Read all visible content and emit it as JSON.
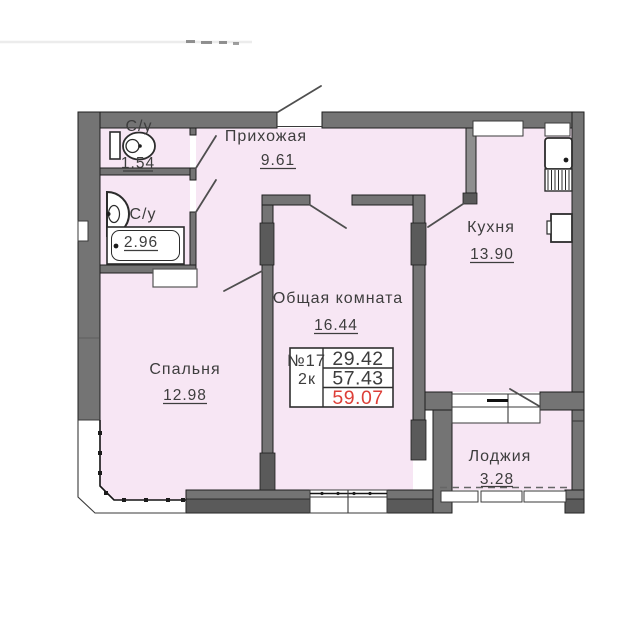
{
  "rooms": {
    "wc": {
      "label": "С/у",
      "area": "1.54"
    },
    "bathroom": {
      "label": "С/у",
      "area": "2.96"
    },
    "hallway": {
      "label": "Прихожая",
      "area": "9.61"
    },
    "kitchen": {
      "label": "Кухня",
      "area": "13.90"
    },
    "living": {
      "label": "Общая комната",
      "area": "16.44"
    },
    "bedroom": {
      "label": "Спальня",
      "area": "12.98"
    },
    "loggia": {
      "label": "Лоджия",
      "area": "3.28"
    }
  },
  "info_box": {
    "unit_number": "№17",
    "unit_type": "2к",
    "living_area": "29.42",
    "area_without_loggia": "57.43",
    "total_area": "59.07"
  },
  "icons": {
    "toilet": "toilet-icon",
    "washbasin": "washbasin-icon",
    "bathtub": "bathtub-icon",
    "kitchen_sink": "kitchen-sink-icon",
    "stove": "stove-icon",
    "vent_niche": "vent-niche"
  },
  "colors": {
    "room_fill": "#f7e6f4",
    "wall": "#747474",
    "wall_dark": "#5a5a5a",
    "wall_light": "#8f8f8f",
    "outline": "#1e1e1e",
    "text": "#3d3d3d",
    "area_red": "#dd3f38"
  }
}
